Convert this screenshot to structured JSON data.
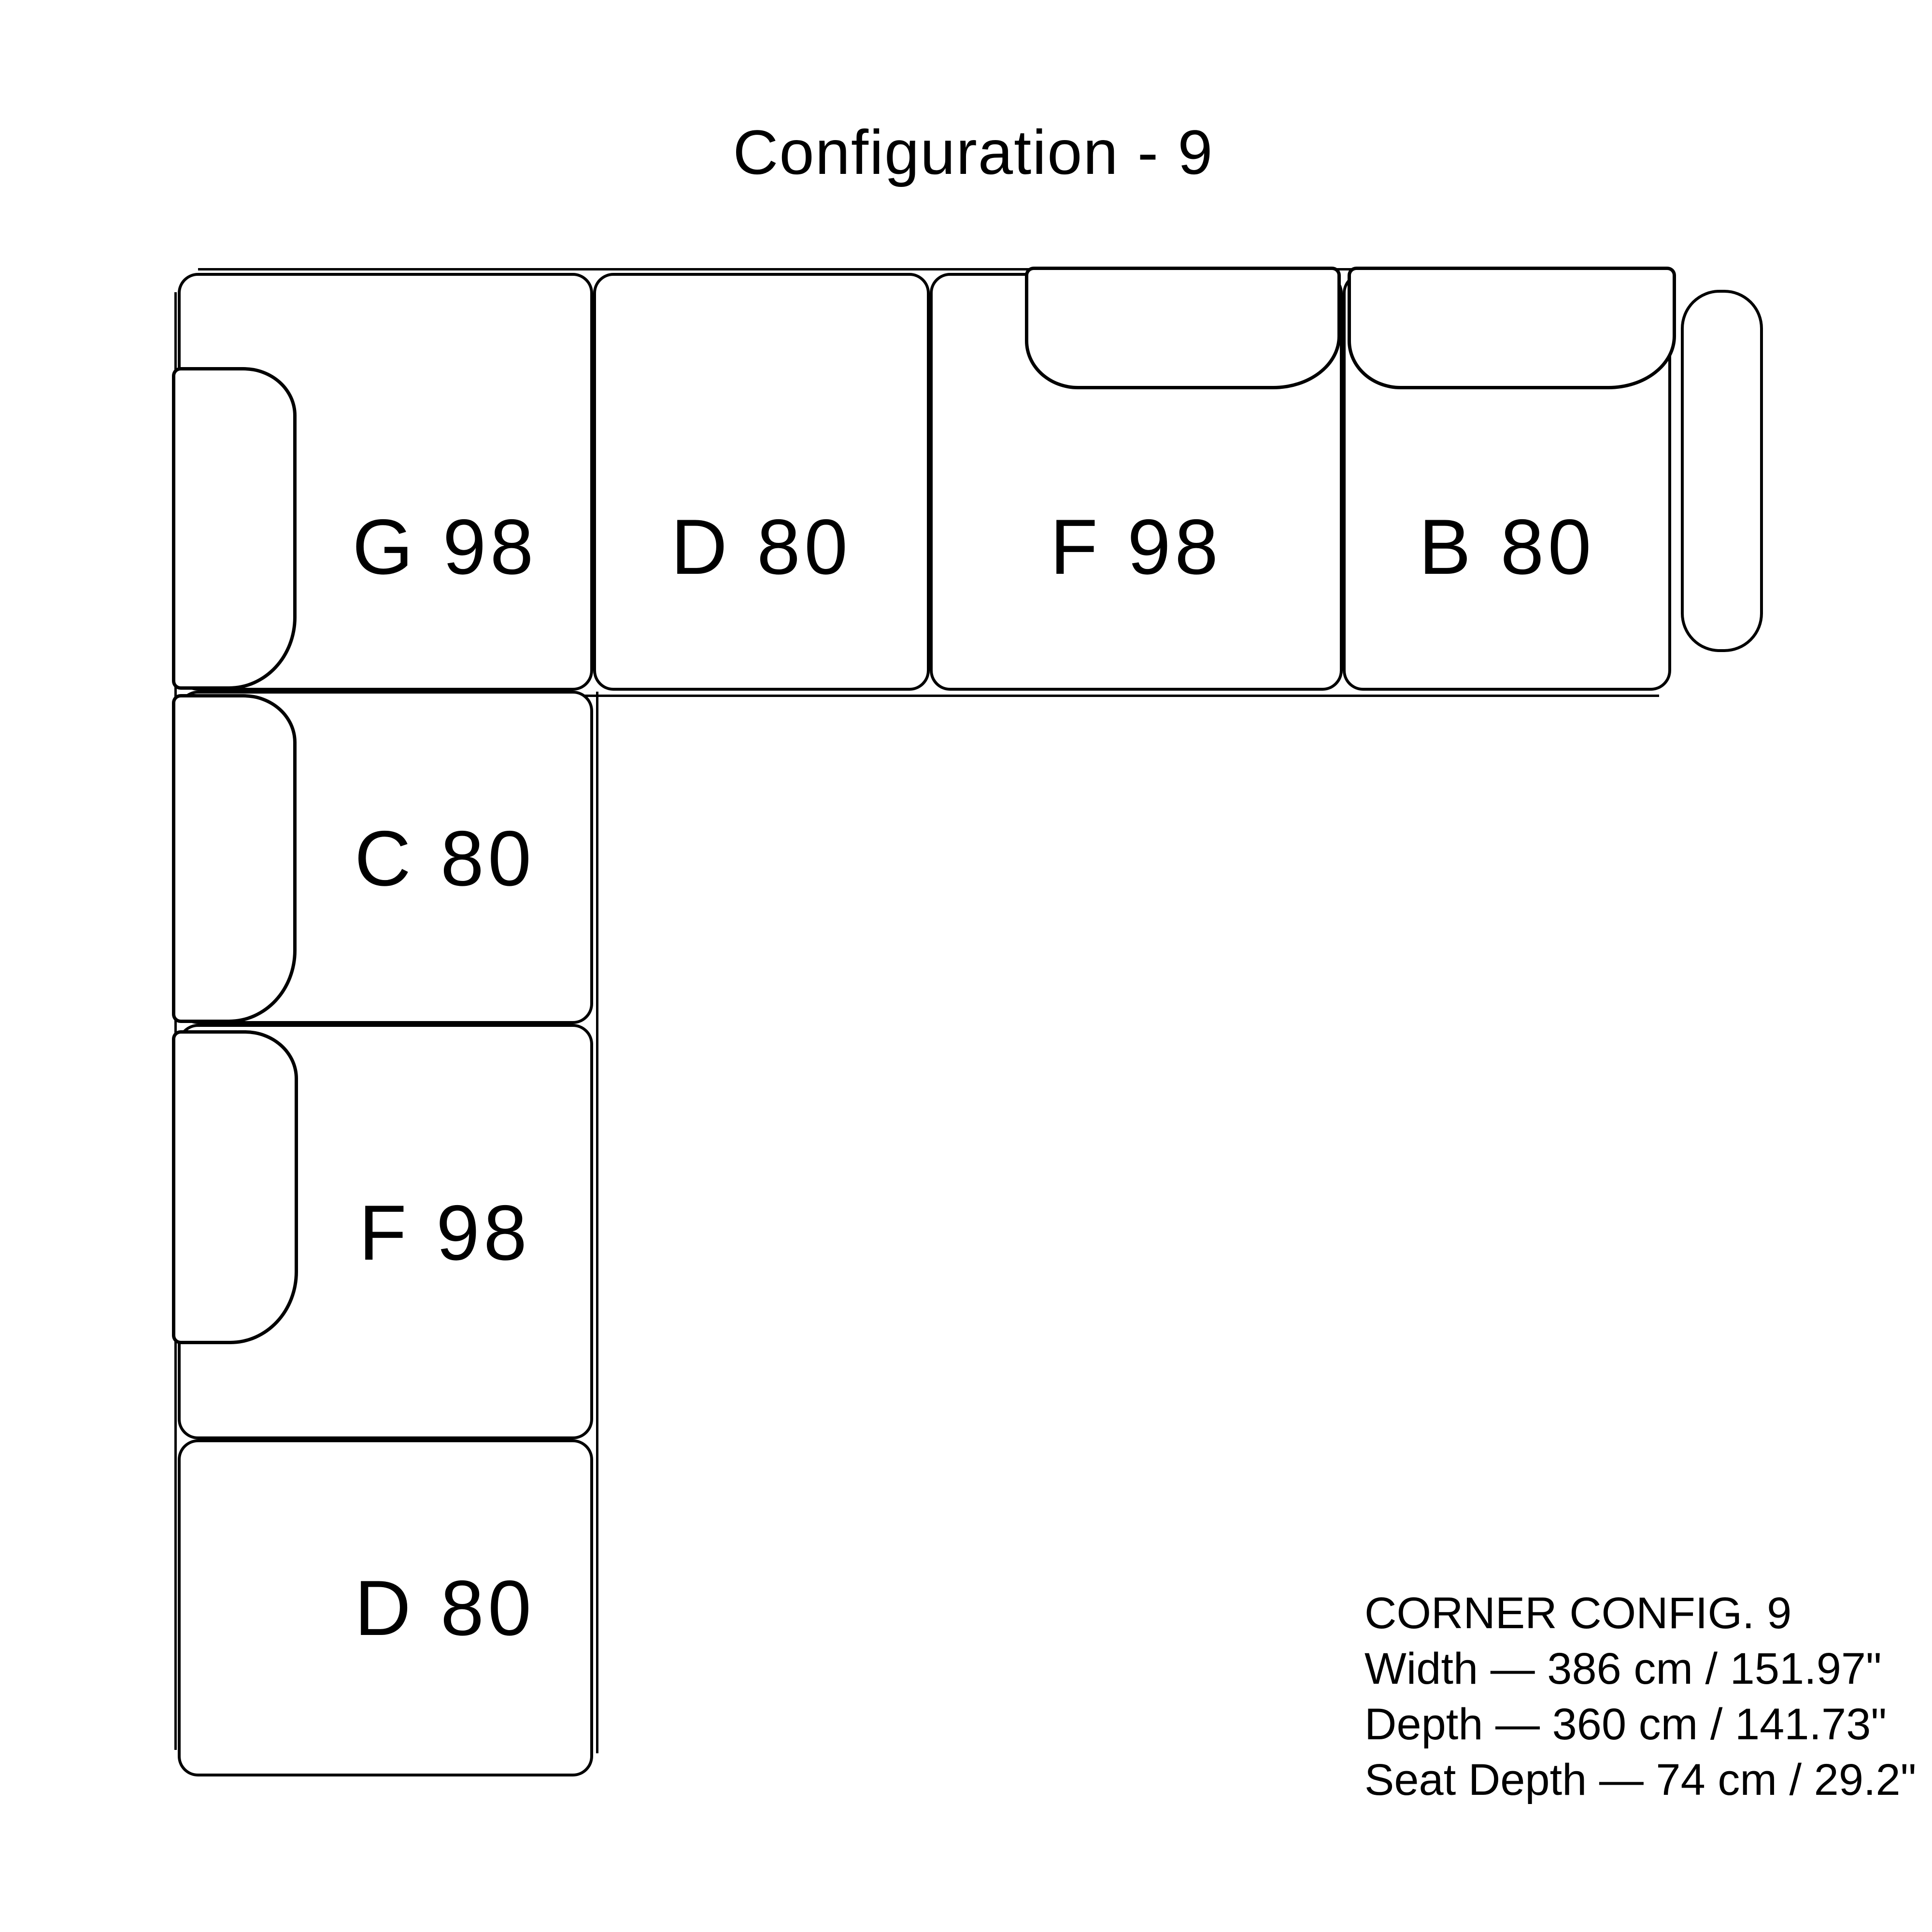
{
  "title": "Configuration - 9",
  "modules": [
    {
      "key": "top-g98",
      "label": "G 98"
    },
    {
      "key": "top-d80",
      "label": "D 80"
    },
    {
      "key": "top-f98",
      "label": "F 98"
    },
    {
      "key": "top-b80",
      "label": "B 80"
    },
    {
      "key": "col-c80",
      "label": "C 80"
    },
    {
      "key": "col-f98",
      "label": "F 98"
    },
    {
      "key": "col-d80",
      "label": "D 80"
    }
  ],
  "specs": {
    "heading": "CORNER CONFIG. 9",
    "width": "Width — 386 cm / 151.97\"",
    "depth": "Depth — 360 cm / 141.73\"",
    "seat_depth": "Seat Depth — 74 cm / 29.2\""
  }
}
